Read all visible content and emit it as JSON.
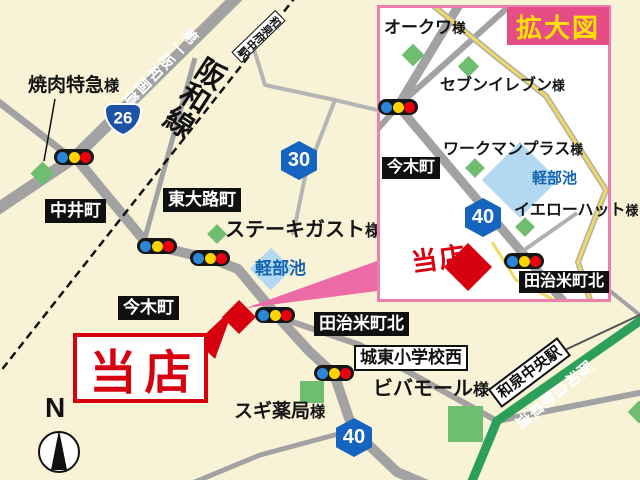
{
  "colors": {
    "background": "#f8f3d6",
    "road_gray": "#a2a2a2",
    "expressway_green": "#2ca05a",
    "yellow_road": "#f0d95c",
    "pond_blue": "#b3d9f2",
    "pond_text_blue": "#1565b0",
    "store_red": "#d7000f",
    "inset_border_pink": "#ec7fae",
    "inset_title_bg": "#e64c86",
    "inset_title_text": "#ffe200",
    "wedge_pink": "#ec6ba6",
    "route_badge_blue": "#1565c0",
    "route_shield_blue": "#1d53a6"
  },
  "main_map": {
    "railway_name": "阪和線",
    "station_hanwa_fuchu": "和泉府中駅",
    "road_daiichi_hanwa": "第一阪和国道",
    "expressway_name": "阪和自動車道",
    "station_izumi_chuo": "和泉中央駅",
    "route_26": "26",
    "route_30": "30",
    "route_40": "40",
    "pond_label": "軽部池",
    "store_label": "当店",
    "compass_label": "N",
    "towns": {
      "nakai": "中井町",
      "higashioji": "東大路町",
      "imaki": "今木町",
      "tajirimachi_kita": "田治米町北",
      "joto_shogakko_nishi": "城東小学校西"
    },
    "landmarks": {
      "yakiniku_tokkyu": {
        "name": "焼肉特急",
        "suffix": "様"
      },
      "steak_gusto": {
        "name": "ステーキガスト",
        "suffix": "様"
      },
      "viva_mall": {
        "name": "ビバモール",
        "suffix": "様"
      },
      "sugi_pharmacy": {
        "name": "スギ薬局",
        "suffix": "様"
      }
    }
  },
  "inset": {
    "title": "拡大図",
    "route_40": "40",
    "pond_label": "軽部池",
    "store_label": "当店",
    "towns": {
      "imaki": "今木町",
      "tajirimachi_kita": "田治米町北"
    },
    "landmarks": {
      "okuwa": {
        "name": "オークワ",
        "suffix": "様"
      },
      "seven_eleven": {
        "name": "セブンイレブン",
        "suffix": "様"
      },
      "workman_plus": {
        "name": "ワークマンプラス",
        "suffix": "様"
      },
      "yellow_hat": {
        "name": "イエローハット",
        "suffix": "様"
      }
    }
  }
}
